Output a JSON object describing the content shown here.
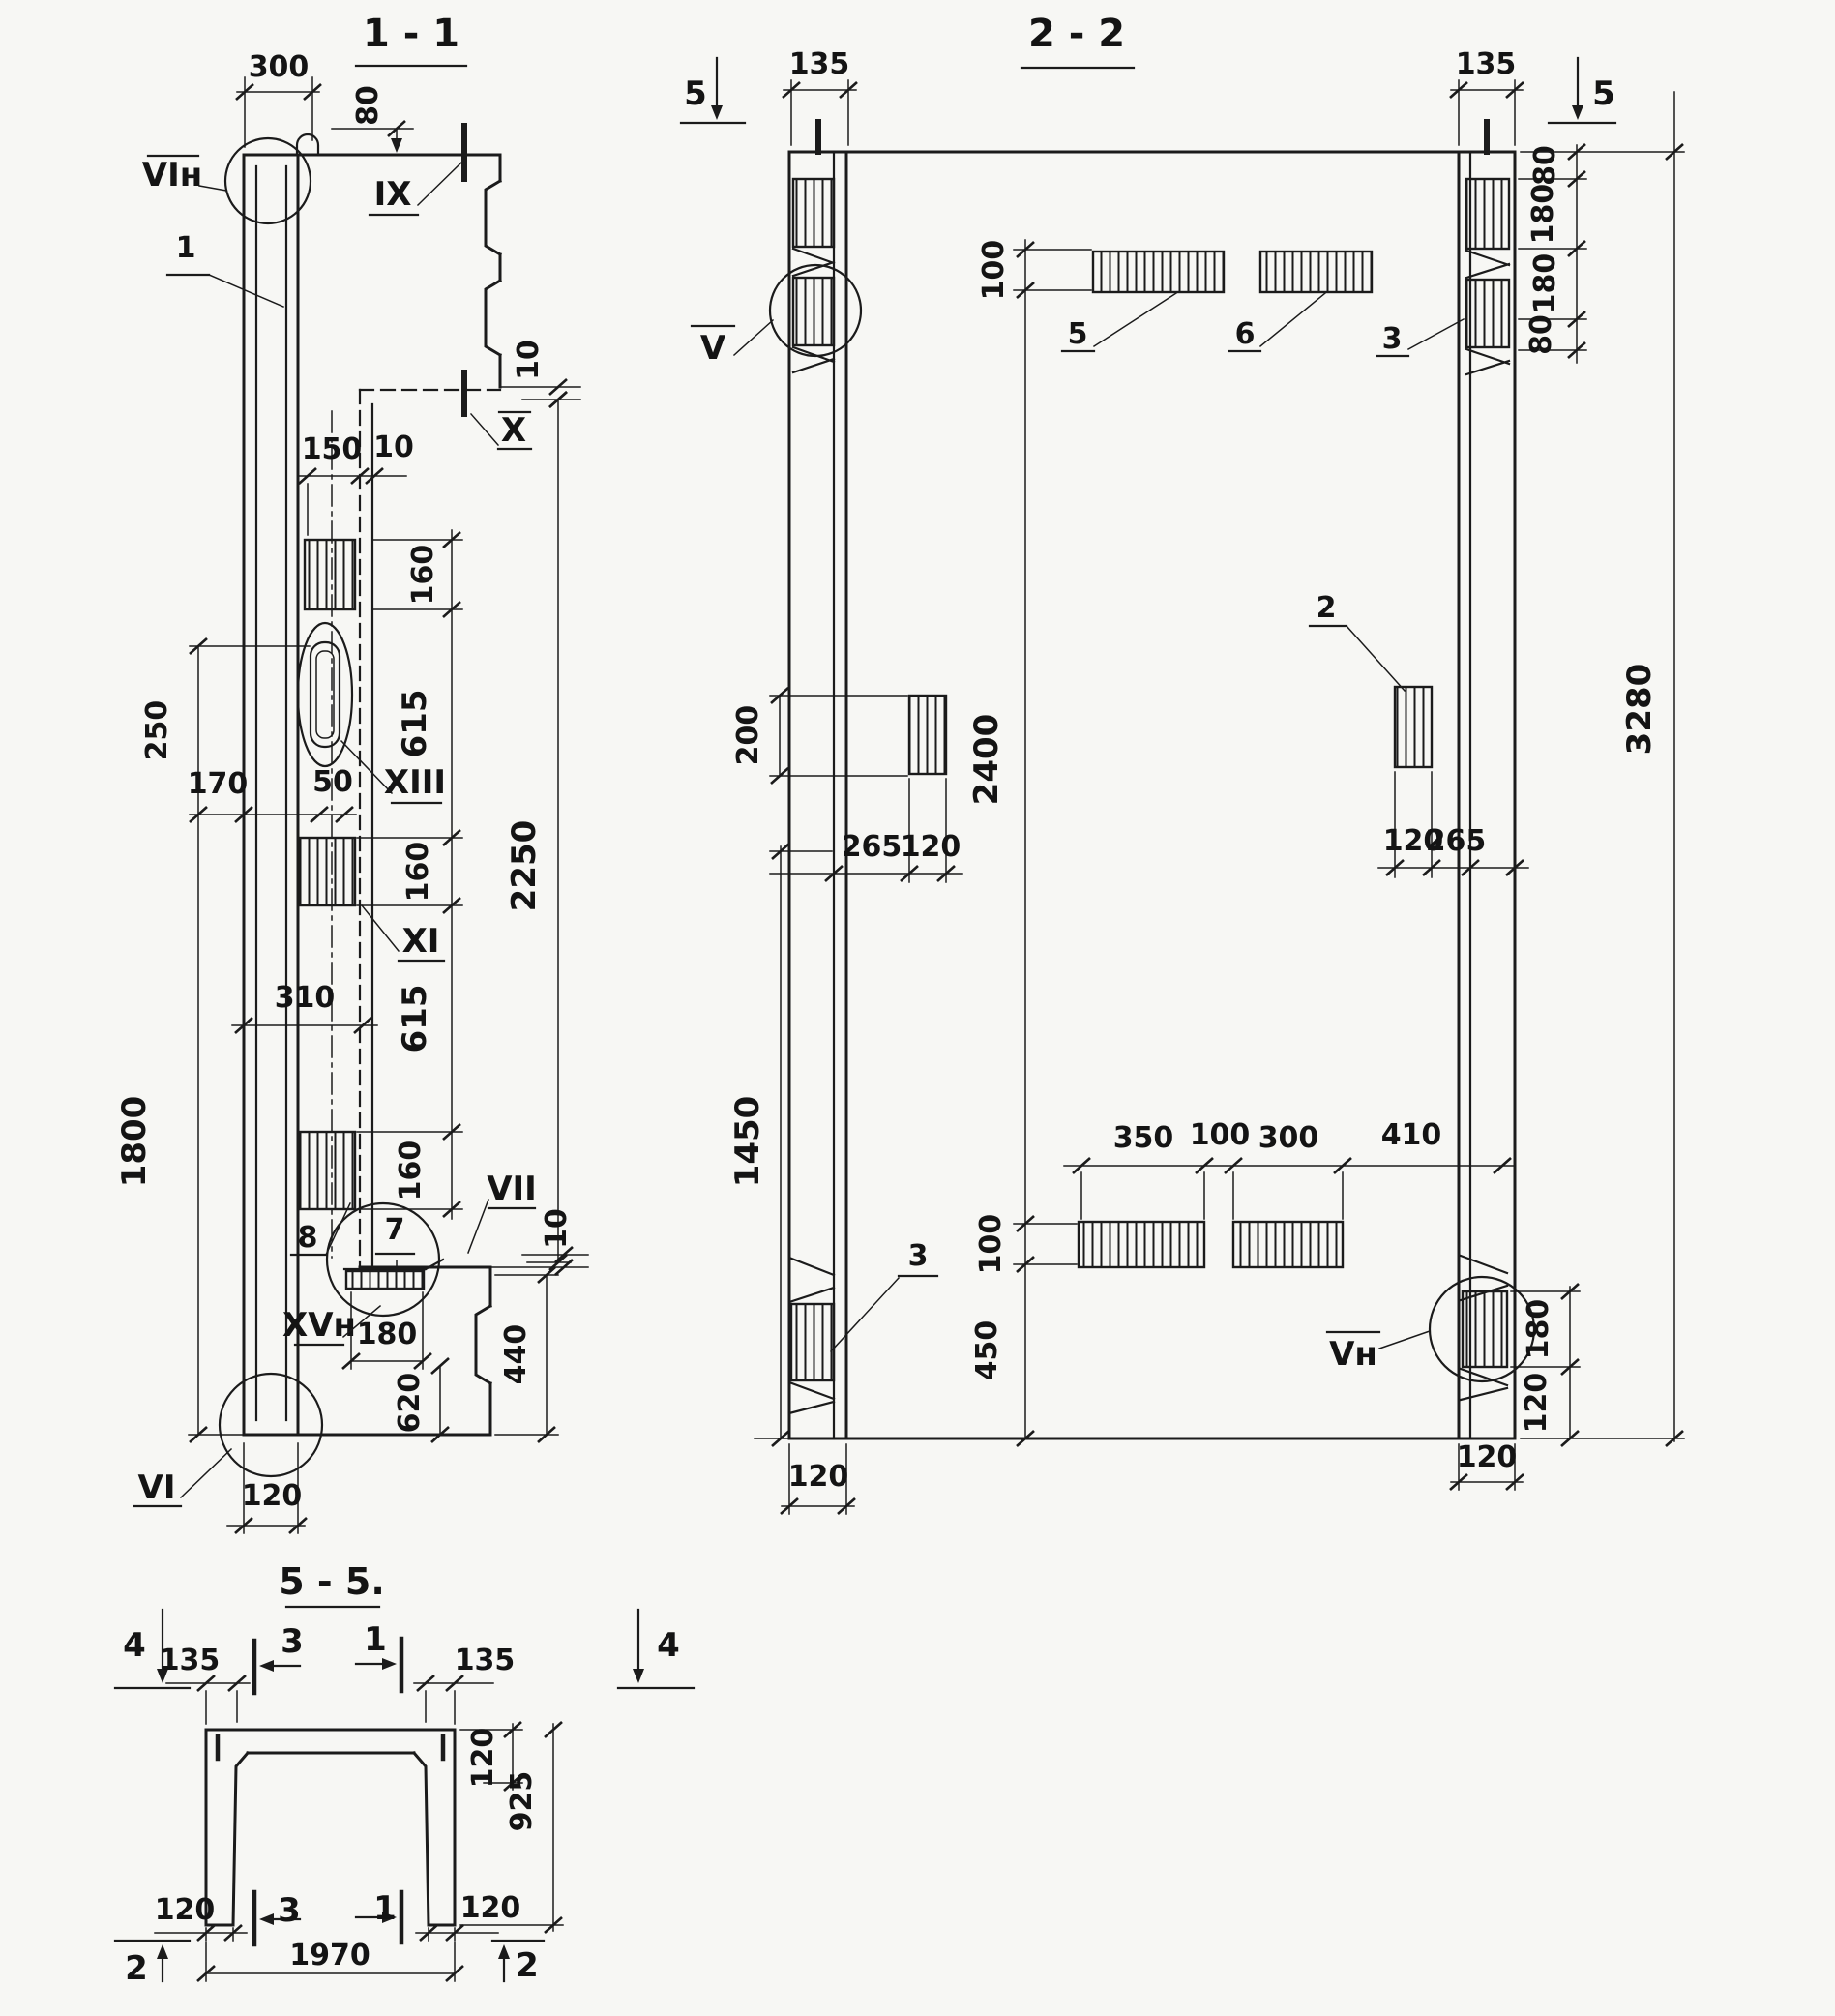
{
  "drawing": {
    "type": "reinforced-concrete panel shop drawing, sections",
    "ink_color": "#1b1b1b",
    "paper_color": "#f7f7f4"
  },
  "s11": {
    "title": "1 - 1",
    "labels": {
      "vin": "VIн",
      "ix": "IX",
      "x": "X",
      "xiii": "XIII",
      "xi": "XI",
      "vii": "VII",
      "xvn": "XVн",
      "vi": "VI"
    },
    "callouts": {
      "c1": "1",
      "c7": "7",
      "c8": "8"
    },
    "dims": {
      "d300": "300",
      "d80": "80",
      "d10a": "10",
      "d2250": "2250",
      "d150": "150",
      "d10b": "10",
      "d160a": "160",
      "d615a": "615",
      "d160b": "160",
      "d615b": "615",
      "d160c": "160",
      "d250": "250",
      "d170": "170",
      "d50": "50",
      "d1800": "1800",
      "d310": "310",
      "d10c": "10",
      "d180": "180",
      "d620": "620",
      "d440": "440",
      "d120": "120"
    }
  },
  "s22": {
    "title": "2 - 2",
    "markers": {
      "m5l": "5",
      "m5r": "5"
    },
    "labels": {
      "v": "V",
      "vn": "Vн"
    },
    "callouts": {
      "c5": "5",
      "c6": "6",
      "c3t": "3",
      "c2": "2",
      "c3b": "3"
    },
    "dims": {
      "d135l": "135",
      "d135r": "135",
      "d80a": "80",
      "d180a": "180",
      "d180b": "180",
      "d80b": "80",
      "d100t": "100",
      "d2400": "2400",
      "d100m": "100",
      "d450": "450",
      "d200": "200",
      "d265l": "265",
      "d120l": "120",
      "d120r": "120",
      "d265r": "265",
      "d1450": "1450",
      "d350": "350",
      "d100r": "100",
      "d300": "300",
      "d410": "410",
      "d180c": "180",
      "d120c": "120",
      "d120bl": "120",
      "d120br": "120",
      "d3280": "3280"
    }
  },
  "s55": {
    "title": "5 - 5.",
    "markers": {
      "m4l": "4",
      "m4r": "4",
      "m2l": "2",
      "m2r": "2"
    },
    "cuts": {
      "c3t": "3",
      "c1t": "1",
      "c3b": "3",
      "c1b": "1"
    },
    "dims": {
      "d135l": "135",
      "d135r": "135",
      "d120tr": "120",
      "d925": "925",
      "d120bl": "120",
      "d120br": "120",
      "d1970": "1970"
    }
  }
}
